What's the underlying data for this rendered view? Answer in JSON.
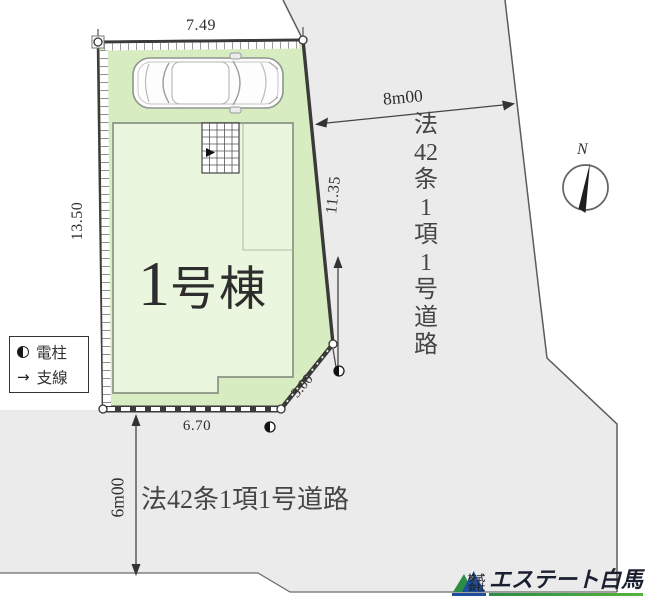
{
  "title": {
    "number": "1",
    "suffix": "号棟"
  },
  "dimensions": {
    "top": "7.49",
    "left": "13.50",
    "right": "11.35",
    "bottom": "6.70",
    "corner": "3.00"
  },
  "roads": {
    "east": {
      "width_label": "8m00",
      "name": "法42条1項1号道路",
      "name_parts": [
        "法",
        "42",
        "条",
        "1",
        "項",
        "1",
        "号",
        "道",
        "路"
      ]
    },
    "south": {
      "width_label": "6m00",
      "name": "法42条1項1号道路"
    }
  },
  "legend": {
    "pole": "電柱",
    "wire": "支線",
    "wire_arrow": "→"
  },
  "compass": {
    "north_label": "N"
  },
  "logo": {
    "prefix_top": "株式",
    "prefix_bottom": "会社",
    "company": "エステート白馬"
  },
  "colors": {
    "plot_fill": "#d8ecc1",
    "building_fill": "#eaf6dd",
    "road_fill": "#ebebeb",
    "boundary": "#3d3d3d",
    "logo_green": "#2d8c46",
    "logo_blue": "#1e4f9c"
  }
}
